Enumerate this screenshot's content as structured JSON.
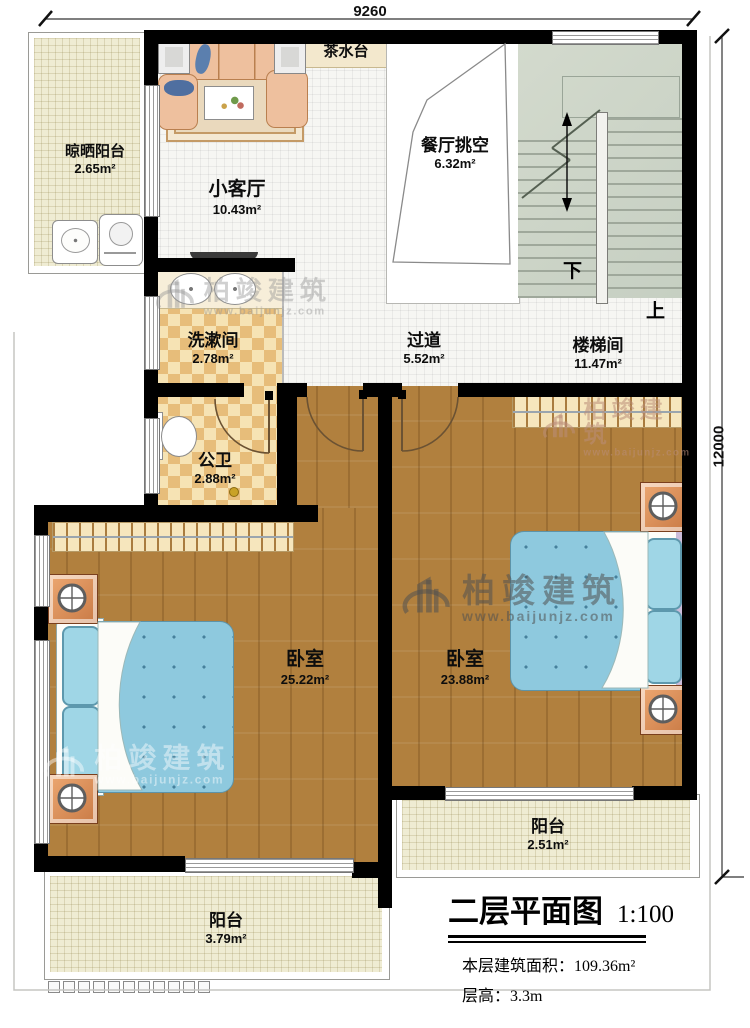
{
  "dimensions": {
    "top": "9260",
    "right": "12000"
  },
  "rooms": [
    {
      "name": "晾晒阳台",
      "area": "2.65m²"
    },
    {
      "name": "小客厅",
      "area": "10.43m²"
    },
    {
      "name": "茶水台",
      "area": ""
    },
    {
      "name": "餐厅挑空",
      "area": "6.32m²"
    },
    {
      "name": "楼梯间",
      "area": "11.47m²"
    },
    {
      "name": "洗漱间",
      "area": "2.78m²"
    },
    {
      "name": "过道",
      "area": "5.52m²"
    },
    {
      "name": "公卫",
      "area": "2.88m²"
    },
    {
      "name": "卧室",
      "area": "25.22m²"
    },
    {
      "name": "卧室",
      "area": "23.88m²"
    },
    {
      "name": "阳台",
      "area": "2.51m²"
    },
    {
      "name": "阳台",
      "area": "3.79m²"
    }
  ],
  "stairs": {
    "down": "下",
    "up": "上"
  },
  "title": {
    "name": "二层平面图",
    "scale": "1:100",
    "area_line": "本层建筑面积：109.36m²",
    "height_line": "层高：3.3m"
  },
  "watermark": {
    "brand": "柏竣建筑",
    "url": "www.baijunjz.com"
  }
}
